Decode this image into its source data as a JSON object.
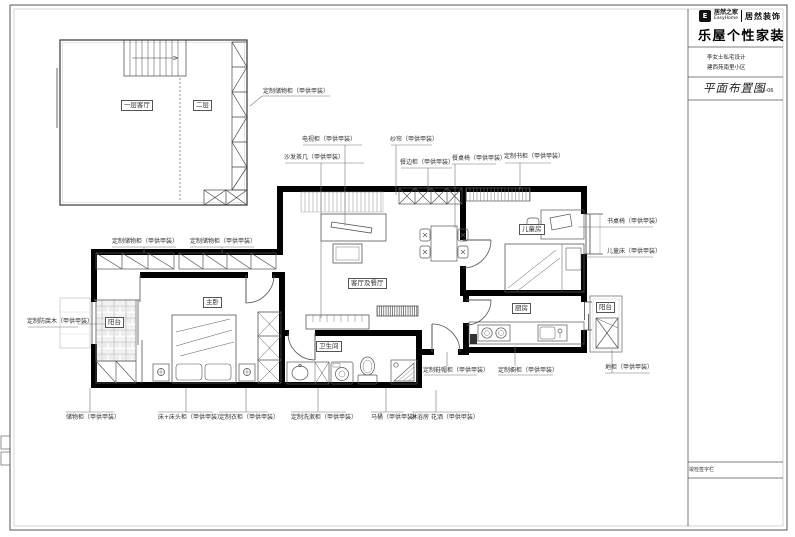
{
  "sheet": {
    "logo": {
      "brand": "居然之家",
      "brand_en": "EasyHome",
      "division": "居然装饰"
    },
    "brand_title": "乐屋个性家装",
    "project": {
      "line1": "李女士私宅设计",
      "line2": "建西苑南里小区"
    },
    "drawing": {
      "title": "平面布置图",
      "number": "LI-06"
    },
    "footer_note": "竣检签字栏"
  },
  "rooms": {
    "loft_living": "一层客厅",
    "loft_second": "二层",
    "living_dining": "客厅及餐厅",
    "kids": "儿童房",
    "master": "主卧",
    "balcony_left": "阳台",
    "bath": "卫生间",
    "kitchen": "厨房",
    "balcony_right": "阳台"
  },
  "callouts": {
    "loft_storage": "定制储物柜（甲供甲装）",
    "tv_cabinet": "电视柜（甲供甲装）",
    "sheer_curtain": "纱帘（甲供甲装）",
    "sofa_tea_table": "沙发茶几（甲供甲装）",
    "sideboard": "餐边柜（甲供甲装）",
    "dining_set": "餐桌椅（甲供甲装）",
    "bookcase": "定制书柜（甲供甲装）",
    "storage_1": "定制储物柜（甲供甲装）",
    "storage_2": "定制储物柜（甲供甲装）",
    "desk_chair": "书桌椅（甲供甲装）",
    "kids_bed": "儿童床（甲供甲装）",
    "floor_cabinet": "地柜（甲供甲装）",
    "deck_wood": "定制防腐木（甲供甲装）",
    "storage_bottom": "储物柜（甲供甲装）",
    "bed_nightstands": "床+床头柜（甲供甲装）",
    "wardrobe": "定制衣柜（甲供甲装）",
    "vanity": "定制洗漱柜（甲供甲装）",
    "toilet": "马桶（甲供甲装）",
    "shower": "淋浴房 花洒（甲供甲装）",
    "shoe_cabinet": "定制鞋帽柜（甲供甲装）",
    "kitchen_cabinets": "定制橱柜（甲供甲装）"
  }
}
